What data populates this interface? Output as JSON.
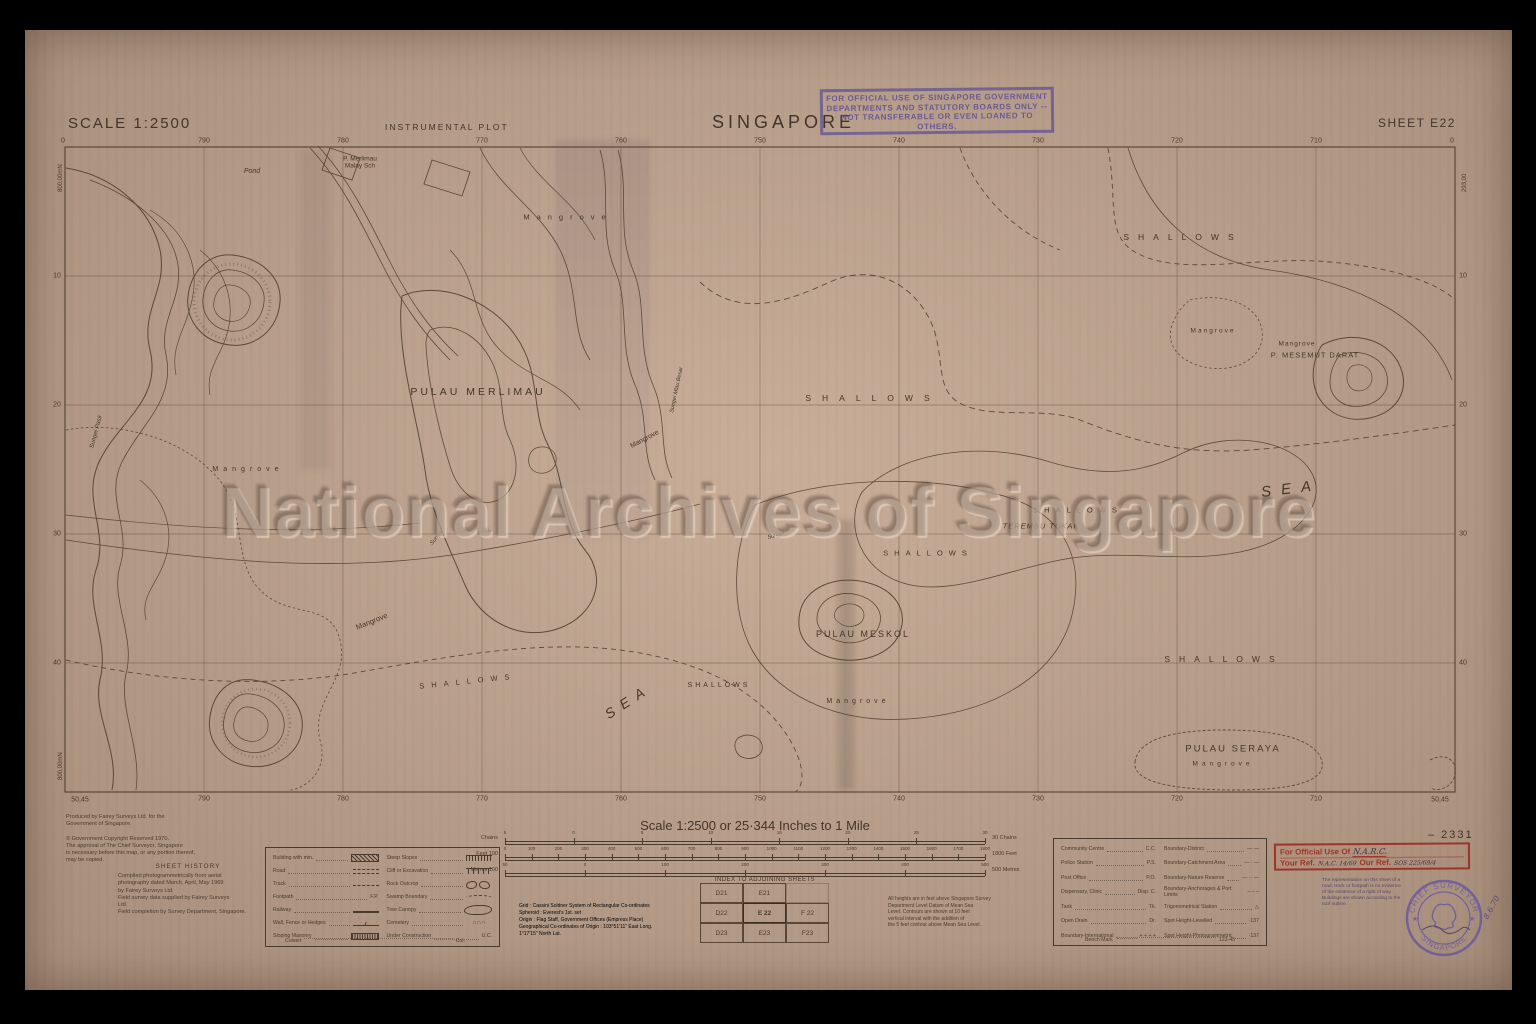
{
  "header": {
    "scale_label": "SCALE 1:2500",
    "plot_type": "INSTRUMENTAL PLOT",
    "title": "SINGAPORE",
    "sheet_label": "SHEET E22",
    "official_stamp_lines": [
      "FOR OFFICIAL USE OF SINGAPORE GOVERNMENT",
      "DEPARTMENTS AND STATUTORY BOARDS ONLY --",
      "NOT TRANSFERABLE OR EVEN LOANED TO OTHERS."
    ]
  },
  "watermark_text": "National Archives of Singapore",
  "map": {
    "grid": {
      "top": [
        "790",
        "780",
        "770",
        "760",
        "750",
        "740",
        "730",
        "720",
        "710"
      ],
      "bottom": [
        "790",
        "780",
        "770",
        "760",
        "750",
        "740",
        "730",
        "720",
        "710"
      ],
      "left": [
        "10",
        "20",
        "30",
        "40"
      ],
      "right": [
        "10",
        "20",
        "30",
        "40"
      ],
      "corner_zero": "0",
      "corner_bottom": "50,45",
      "left_vertical": "800,00mN",
      "right_vertical": "293,00"
    },
    "labels": [
      {
        "t": "Pond",
        "x": 252,
        "y": 172,
        "fs": 7,
        "it": 1
      },
      {
        "t": "P. Merlimau\nMalay Sch",
        "x": 360,
        "y": 163,
        "fs": 6.5
      },
      {
        "t": "Mangrove",
        "x": 568,
        "y": 218,
        "fs": 7.5,
        "ls": 7
      },
      {
        "t": "SHALLOWS",
        "x": 1183,
        "y": 238,
        "fs": 8.5,
        "ls": 9
      },
      {
        "t": "Mangrove",
        "x": 1213,
        "y": 331,
        "fs": 6.5,
        "ls": 2
      },
      {
        "t": "Mangrove",
        "x": 1297,
        "y": 344,
        "fs": 6.5,
        "ls": 1
      },
      {
        "t": "P. MESEMUT DARAT",
        "x": 1315,
        "y": 356,
        "fs": 7.5,
        "ls": 1
      },
      {
        "t": "PULAU MERLIMAU",
        "x": 478,
        "y": 392,
        "fs": 10.5,
        "ls": 3
      },
      {
        "t": "SHALLOWS",
        "x": 873,
        "y": 399,
        "fs": 8.5,
        "ls": 11
      },
      {
        "t": "Mangrove",
        "x": 645,
        "y": 440,
        "fs": 7,
        "rot": -28
      },
      {
        "t": "Mangrove",
        "x": 248,
        "y": 470,
        "fs": 7,
        "ls": 5
      },
      {
        "t": "Sungei Pasir",
        "x": 97,
        "y": 432,
        "fs": 6,
        "rot": -75,
        "it": 1
      },
      {
        "t": "SEA",
        "x": 1291,
        "y": 489,
        "fs": 15,
        "ls": 10,
        "it": 1,
        "rot": -7
      },
      {
        "t": "SHALLOWS",
        "x": 1078,
        "y": 511,
        "fs": 7.5,
        "ls": 6
      },
      {
        "t": "TEREMBU TUKAK",
        "x": 1041,
        "y": 527,
        "fs": 7.5,
        "it": 1,
        "ls": 1
      },
      {
        "t": "SHALLOWS",
        "x": 928,
        "y": 554,
        "fs": 7.5,
        "ls": 6
      },
      {
        "t": "Sungei",
        "x": 776,
        "y": 536,
        "fs": 5.5,
        "it": 1,
        "rot": -15
      },
      {
        "t": "Sungei",
        "x": 437,
        "y": 538,
        "fs": 5.5,
        "it": 1,
        "rot": -50
      },
      {
        "t": "Sungei Mlau Besar",
        "x": 677,
        "y": 390,
        "fs": 5.5,
        "it": 1,
        "rot": -78
      },
      {
        "t": "Mangrove",
        "x": 372,
        "y": 622,
        "fs": 7.5,
        "rot": -22
      },
      {
        "t": "PULAU MESKOL",
        "x": 863,
        "y": 634,
        "fs": 9,
        "ls": 2
      },
      {
        "t": "SHALLOWS",
        "x": 1224,
        "y": 660,
        "fs": 8.5,
        "ls": 9
      },
      {
        "t": "SHALLOWS",
        "x": 468,
        "y": 682,
        "fs": 7.5,
        "ls": 7,
        "rot": -6
      },
      {
        "t": "SHALLOWS",
        "x": 719,
        "y": 686,
        "fs": 7,
        "ls": 3
      },
      {
        "t": "SEA",
        "x": 628,
        "y": 701,
        "fs": 14,
        "ls": 8,
        "it": 1,
        "rot": -33
      },
      {
        "t": "Mangrove",
        "x": 858,
        "y": 702,
        "fs": 7,
        "ls": 4
      },
      {
        "t": "PULAU SERAYA",
        "x": 1233,
        "y": 750,
        "fs": 9.5,
        "ls": 2
      },
      {
        "t": "Mangrove",
        "x": 1223,
        "y": 764,
        "fs": 6.5,
        "ls": 4
      }
    ]
  },
  "footer": {
    "scale_title": "Scale 1:2500 or 25·344 Inches to 1 Mile",
    "bars": [
      {
        "left_label": "Chains",
        "right_label": "30 Chains",
        "ticks": [
          "5",
          "0",
          "5",
          "10",
          "15",
          "20",
          "25",
          "30"
        ]
      },
      {
        "left_label": "Feet 100",
        "right_label": "1800 Feet",
        "ticks": [
          "0",
          "100",
          "200",
          "300",
          "400",
          "500",
          "600",
          "700",
          "800",
          "900",
          "1000",
          "1100",
          "1200",
          "1300",
          "1400",
          "1500",
          "1600",
          "1700",
          "1800"
        ]
      },
      {
        "left_label": "Metres 100",
        "right_label": "500 Metres",
        "ticks": [
          "50",
          "0",
          "100",
          "200",
          "300",
          "400",
          "500"
        ]
      }
    ],
    "credits_lines": [
      "Produced by Fairey Surveys Ltd. for the",
      "Government of Singapore.",
      "",
      "© Government Copyright Reserved 1970.",
      "The approval of The Chief Surveyor, Singapore",
      "is necessary before this map, or any portion thereof,",
      "may be copied."
    ],
    "sheet_history": {
      "title": "SHEET HISTORY",
      "lines": [
        "Compiled photogrammetrically from aerial",
        "photography dated March, April, May 1969",
        "by Fairey Surveys Ltd.",
        "Field survey data supplied by Fairey Surveys",
        "Ltd.",
        "Field completion by Survey Department, Singapore."
      ]
    },
    "legend1": {
      "left": [
        {
          "label": "Building with min.",
          "sym": "building"
        },
        {
          "label": "Road",
          "sym": "road"
        },
        {
          "label": "Track",
          "sym": "track"
        },
        {
          "label": "Footpath",
          "abbr": "F.P."
        },
        {
          "label": "Railway",
          "sym": "railway"
        },
        {
          "label": "Wall, Fence or Hedges",
          "sym": "wall"
        },
        {
          "label": "Sloping Masonry",
          "sym": "masonry"
        }
      ],
      "right": [
        {
          "label": "Steep Slopes",
          "sym": "steep"
        },
        {
          "label": "Cliff or Excavation",
          "sym": "cliff"
        },
        {
          "label": "Rock Outcrop",
          "sym": "rock"
        },
        {
          "label": "Swamp Boundary",
          "sym": "swamp"
        },
        {
          "label": "Tree Canopy",
          "sym": "tree"
        },
        {
          "label": "Cemetery",
          "sym": "cem",
          "glyph": "∩∩∩"
        },
        {
          "label": "Under Construction",
          "abbr": "U.C."
        }
      ],
      "culvert": {
        "label": "Culvert",
        "abbr": "Cul."
      }
    },
    "grid_info_lines": [
      "Grid :      Cassini Soldner System of Rectangular Co-ordinates",
      "Spheroid :  Everest's 1st. set",
      "Origin :    Flag Staff, Government Offices (Empress Place)",
      "Geographical Co-ordinates of Origin : 103°51'11\" East Long.",
      "                       1°17'15\" North Lat."
    ],
    "index": {
      "title": "INDEX TO ADJOINING SHEETS",
      "rows": [
        [
          "D21",
          "E21",
          ""
        ],
        [
          "D22",
          "E 22",
          "F 22"
        ],
        [
          "D23",
          "E23",
          "F23"
        ]
      ],
      "current": "E 22"
    },
    "heights_note_lines": [
      "All heights are in feet above Singapore Survey",
      "Department Level Datum of Mean Sea",
      "Level. Contours are shown at 10 feet",
      "vertical interval with the addition of",
      "the 5 feet contour above Mean Sea Level."
    ],
    "legend2": {
      "left": [
        {
          "label": "Community Centre",
          "abbr": "C.C."
        },
        {
          "label": "Police Station",
          "abbr": "P.S."
        },
        {
          "label": "Post Office",
          "abbr": "P.O."
        },
        {
          "label": "Dispensary, Clinic",
          "abbr": "Disp. C."
        },
        {
          "label": "Tank",
          "abbr": "Tk."
        },
        {
          "label": "Open Drain",
          "abbr": "Dr."
        },
        {
          "label": "Boundary-International",
          "abbr": "+ + + +"
        }
      ],
      "right": [
        {
          "label": "Boundary-District",
          "abbr": "— —"
        },
        {
          "label": "Boundary-Catchment Area",
          "abbr": "— · —"
        },
        {
          "label": "Boundary-Nature Reserve",
          "abbr": "— ·· —"
        },
        {
          "label": "Boundary-Anchorages & Port Limits",
          "abbr": "– – –"
        },
        {
          "label": "Trigonometrical Station",
          "abbr": "△"
        },
        {
          "label": "Spot Height-Levelled",
          "abbr": "·137"
        },
        {
          "label": "Spot Height-Photogrammetric",
          "abbr": "·137"
        }
      ],
      "bench": {
        "label": "Bench Mark",
        "abbr": "123·45"
      }
    },
    "red_stamp": {
      "line1_label": "For Official Use Of",
      "line1_value": "N.A.R.C.",
      "line2a_label": "Your Ref.",
      "line2a_value": "N.A.C. 14/69",
      "line2b_label": "Our Ref.",
      "line2b_value": "SOS 225/69/4"
    },
    "rep_note_lines": [
      "The representation on this sheet of a",
      "road, track or footpath is no evidence",
      "of the existence of a right of way.",
      "Buildings are shown according to the",
      "roof outline."
    ],
    "round_stamp": {
      "top": "CHIEF SURVEYOR",
      "bottom": "SINGAPORE"
    },
    "serial": "–  2331",
    "hand_date": "8.6.70"
  }
}
